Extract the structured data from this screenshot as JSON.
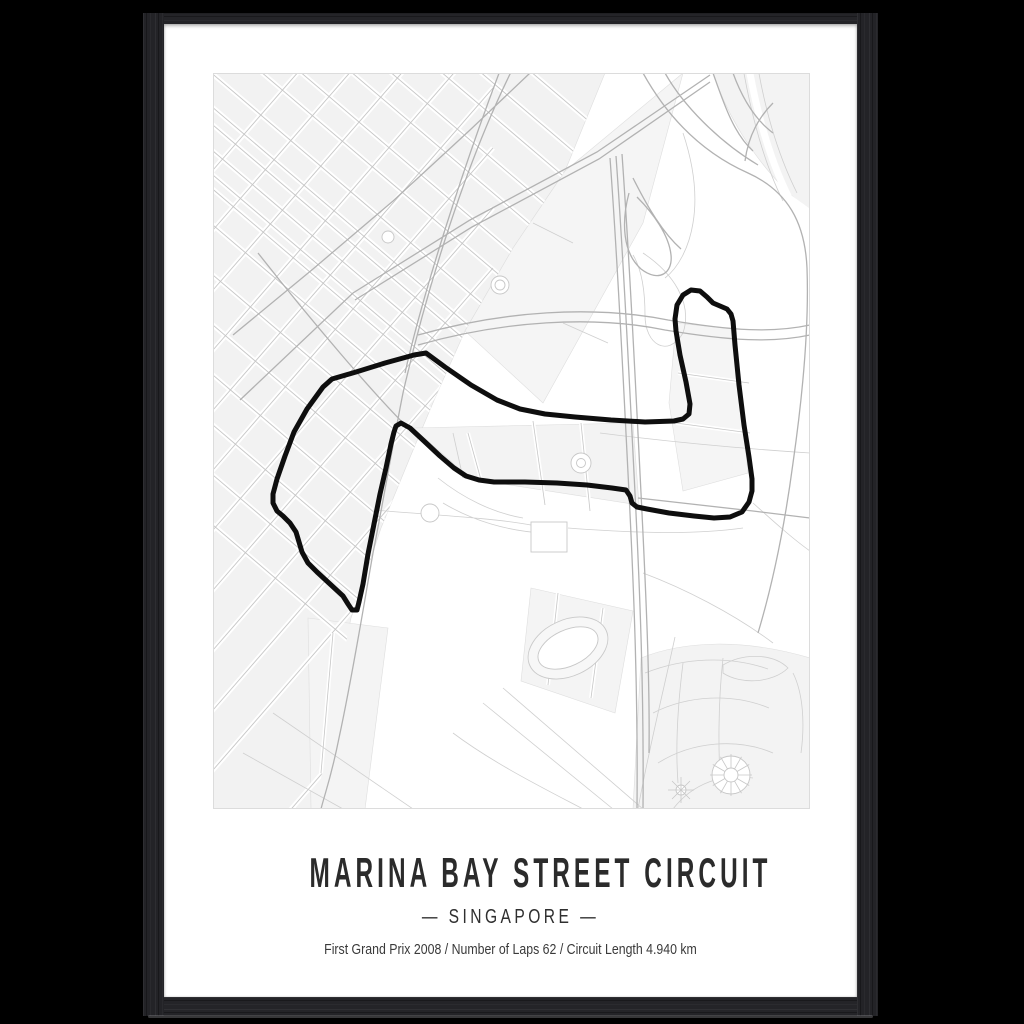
{
  "poster": {
    "title": "MARINA BAY STREET CIRCUIT",
    "subtitle": "— SINGAPORE —",
    "country": "SINGAPORE",
    "details_line": "First Grand Prix 2008 / Number of Laps 62 / Circuit Length 4.940 km",
    "facts": {
      "first_grand_prix": "2008",
      "number_of_laps": "62",
      "circuit_length": "4.940 km"
    }
  },
  "map": {
    "circuit_path": "M213,280 L232,294 L258,312 L284,327 L307,336 L332,341 L362,344 L398,347 L432,349 L461,348 L470,346 L476,341 L477,331 L473,309 L467,282 L463,258 L462,246 L464,232 L470,222 L478,217 L487,218 L494,224 L500,230 L507,233 L514,236 L518,241 L520,248 L522,272 L526,312 L531,352 L536,384 L539,406 L539,418 L536,429 L529,439 L517,444 L501,445 L481,443 L456,440 L434,436 L424,434 L419,430 L417,423 L413,417 L399,415 L374,412 L344,410 L312,409 L281,409 L266,407 L253,403 L241,395 L227,383 L211,368 L197,355 L188,350 L183,353 L181,359 L178,371 L173,395 L167,421 L161,451 L155,481 L150,511 L146,529 L144,537 L139,537 L135,531 L130,523 L117,511 L104,499 L95,490 L89,479 L86,469 L83,459 L77,450 L70,443 L64,438 L60,430 L60,421 L64,406 L72,383 L81,359 L94,336 L110,314 L119,306 L143,299 L172,290 L201,282 Z",
    "colors": {
      "background": "#000000",
      "frame": "#242428",
      "mat": "#ffffff",
      "map_background": "#ffffff",
      "city_blocks": "#f2f2f2",
      "streets": "#c6c6c6",
      "major_roads": "#b2b2b2",
      "circuit_line": "#0e0e0e",
      "title_text": "#2b2b2b"
    }
  }
}
